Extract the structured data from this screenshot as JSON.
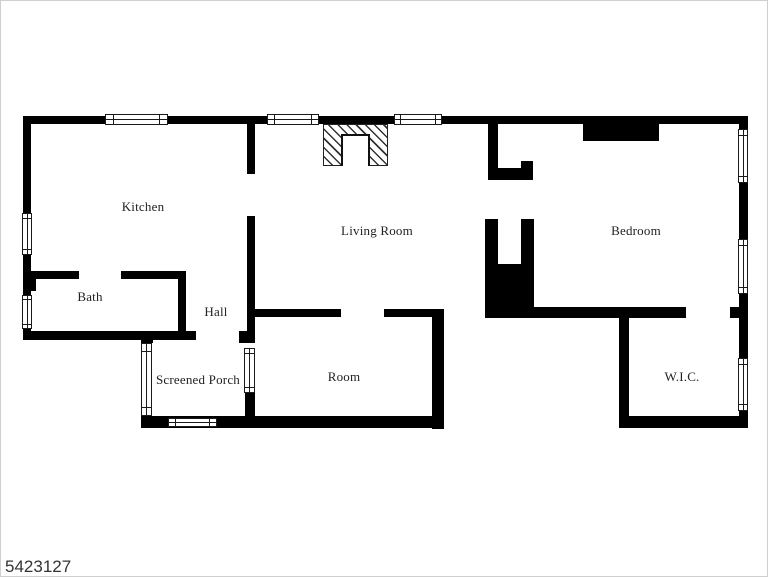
{
  "plan": {
    "id_label": "5423127",
    "colors": {
      "wall": "#000000",
      "background": "#ffffff",
      "label_text": "#222222"
    },
    "rooms": [
      {
        "name": "kitchen",
        "label": "Kitchen"
      },
      {
        "name": "living-room",
        "label": "Living Room"
      },
      {
        "name": "bedroom",
        "label": "Bedroom"
      },
      {
        "name": "bath",
        "label": "Bath"
      },
      {
        "name": "hall",
        "label": "Hall"
      },
      {
        "name": "screened-porch",
        "label": "Screened Porch"
      },
      {
        "name": "room",
        "label": "Room"
      },
      {
        "name": "wic",
        "label": "W.I.C."
      }
    ],
    "features": [
      {
        "name": "fireplace"
      },
      {
        "name": "staircase"
      },
      {
        "name": "bedroom-builtin-closet"
      }
    ]
  }
}
